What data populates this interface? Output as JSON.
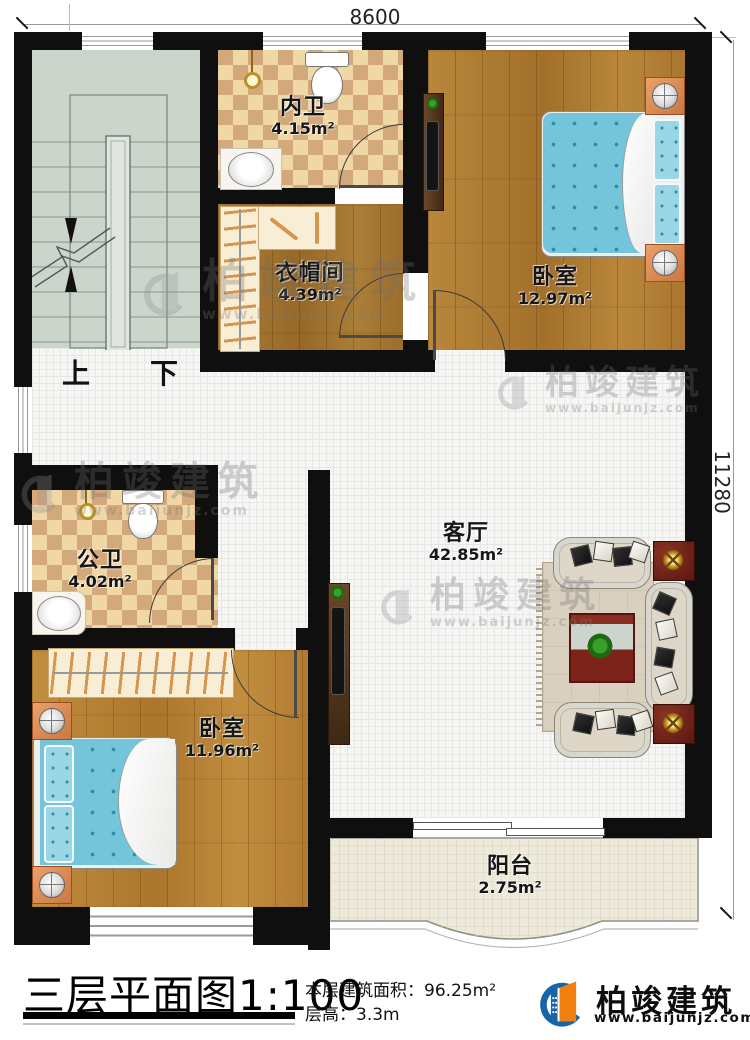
{
  "dimensions": {
    "width": "8600",
    "height": "11280"
  },
  "stairs": {
    "up": "上",
    "down": "下"
  },
  "rooms": {
    "neiwei": {
      "name": "内卫",
      "area": "4.15m²"
    },
    "yimaojian": {
      "name": "衣帽间",
      "area": "4.39m²"
    },
    "bedroom_top": {
      "name": "卧室",
      "area": "12.97m²"
    },
    "gongwei": {
      "name": "公卫",
      "area": "4.02m²"
    },
    "living": {
      "name": "客厅",
      "area": "42.85m²"
    },
    "bedroom_bottom": {
      "name": "卧室",
      "area": "11.96m²"
    },
    "balcony": {
      "name": "阳台",
      "area": "2.75m²"
    }
  },
  "footer": {
    "plan_title": "三层平面图",
    "plan_scale": "1:100",
    "area_label": "本层建筑面积：",
    "area_value": "96.25m²",
    "height_label": "层高：",
    "height_value": "3.3m"
  },
  "brand": {
    "name": "柏竣建筑",
    "url": "www.baijunjz.com"
  },
  "colors": {
    "wall": "#0f0f0f",
    "wood": "#ad7c33",
    "checker_light": "#f0d7a6",
    "checker_dark": "#d3a87a",
    "stairs": "#ccd5cb",
    "balcony_tile": "#edeadc",
    "floor_tile": "#f6f6f5",
    "bed": "#74c4da",
    "brand_blue": "#1565a8",
    "brand_orange": "#f08010"
  }
}
